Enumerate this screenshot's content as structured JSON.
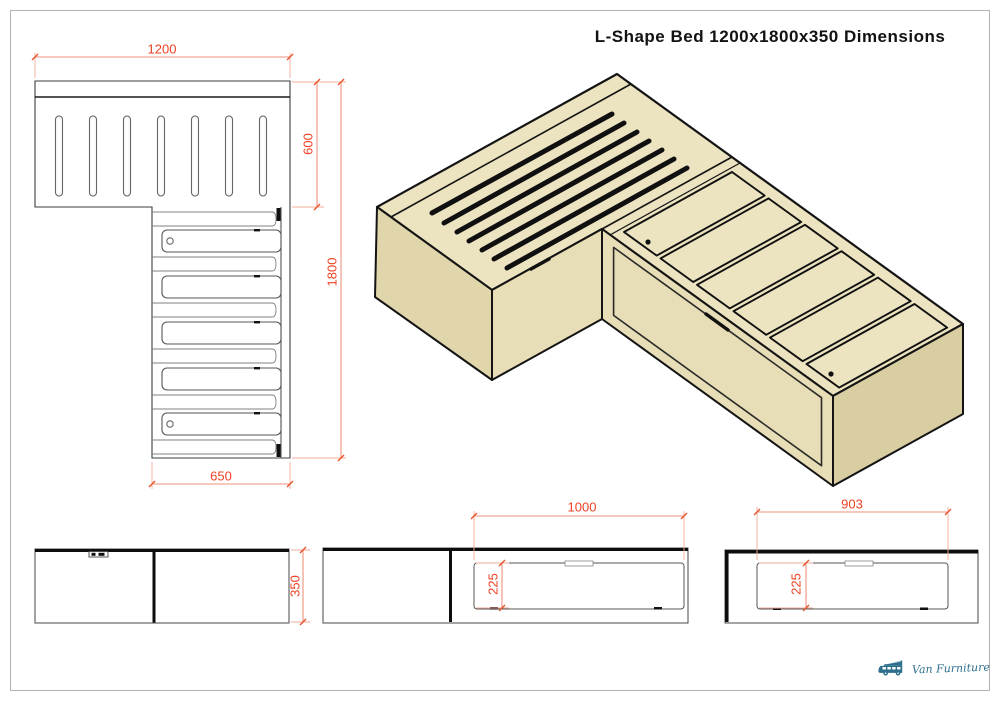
{
  "title": "L-Shape Bed 1200x1800x350 Dimensions",
  "plan_view": {
    "dim_width": "1200",
    "dim_headboard_depth": "600",
    "dim_length": "1800",
    "dim_section_width": "650"
  },
  "front_view": {
    "dim_height": "350"
  },
  "side_view_long": {
    "dim_drawer_width": "1000",
    "dim_drawer_height": "225"
  },
  "side_view_head": {
    "dim_drawer_width": "903",
    "dim_drawer_height": "225"
  },
  "logo": {
    "brand": "Van Furniture"
  },
  "colors": {
    "dimension_text": "#ee4023",
    "dimension_line": "#ee927c",
    "wood_top": "#ece3c0",
    "wood_front": "#e7ddb6",
    "wood_side": "#e0d5ab",
    "wood_end": "#d9cda2",
    "outline": "#141414",
    "logo_teal": "#2e6f8e"
  }
}
